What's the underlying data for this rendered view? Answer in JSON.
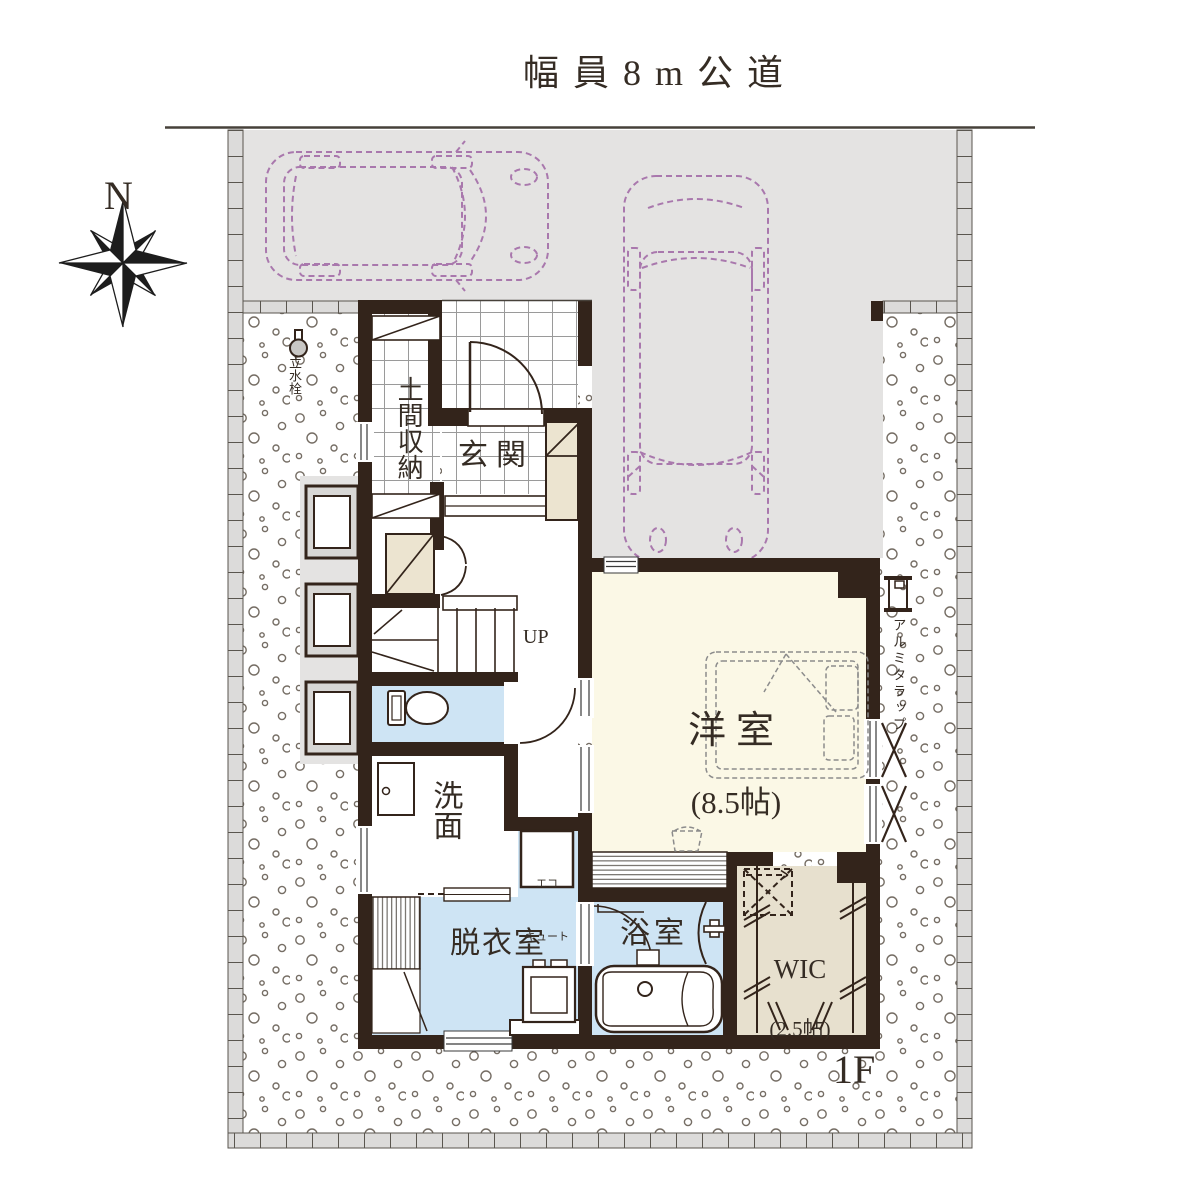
{
  "page": {
    "road_label": "幅員8m公道",
    "floor_label": "1F"
  },
  "compass": {
    "north_label": "N"
  },
  "rooms": {
    "doma_storage": {
      "label": "土間収納"
    },
    "entrance": {
      "label": "玄関"
    },
    "stairs": {
      "label": "UP"
    },
    "washroom": {
      "label": "洗面"
    },
    "dressing_room": {
      "label": "脱衣室"
    },
    "bathroom": {
      "label": "浴室"
    },
    "western_room": {
      "label": "洋室",
      "size": "(8.5帖)"
    },
    "wic": {
      "label": "WIC",
      "size": "(2.5帖)"
    },
    "ecocute": {
      "line1": "エコ",
      "line2": "キュート"
    }
  },
  "exterior": {
    "water_tap_label": "立水栓",
    "ladder_label": "アルミタラップ"
  },
  "icons": [
    "compass-rose-icon",
    "car-top-view-icon",
    "entrance-door-arc-icon",
    "toilet-icon",
    "vanity-icon",
    "bathtub-icon",
    "washing-machine-icon",
    "ecocute-unit-icon",
    "bed-icon",
    "hanger-rod-icon",
    "water-tap-icon",
    "ladder-icon",
    "stairs-up-icon"
  ],
  "colors": {
    "wall": "#33241b",
    "ink": "#352c24",
    "parking": "#e4e3e2",
    "tile": "#dcdbda",
    "wet": "#cee4f4",
    "cream": "#fbf8e6",
    "beige": "#e7e0ce",
    "closet": "#ece4d0",
    "car": "#a978ad",
    "grid": "#9a9a9a",
    "gravel": "#756d64"
  }
}
